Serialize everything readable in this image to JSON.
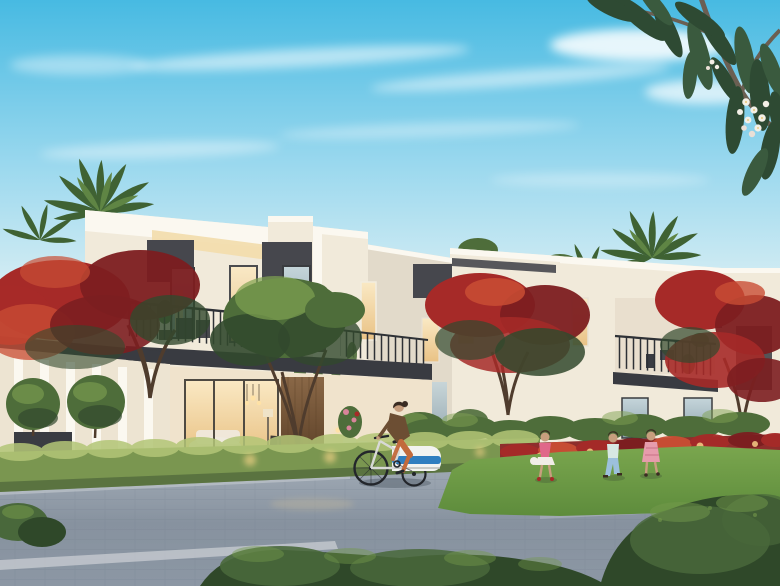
{
  "meta": {
    "kind": "architectural-rendering",
    "subject": "Modern two-storey townhouse community at dusk",
    "style": "photoreal real-estate marketing render",
    "text_visible": "none"
  },
  "scene": {
    "sky": {
      "condition": "clear with thin wispy clouds",
      "time": "early evening, warm horizon glow"
    },
    "architecture": {
      "type": "contemporary flat-roof townhouses",
      "storeys": 2,
      "facade": [
        "warm white render",
        "dark grey accent panels",
        "recessed lit soffits"
      ],
      "features": [
        "first-floor balconies with dark metal railings",
        "floor-to-ceiling glazing with warm interior light",
        "timber entrance panel",
        "pergola wing with white columns"
      ]
    },
    "vegetation": [
      "royal poinciana trees with red blossoms",
      "date palms",
      "frangipani branch with white flowers overhanging top-right",
      "clipped round trees",
      "green hedge with garden uplights",
      "red flowering hedge",
      "lawn",
      "low foreground shrubs"
    ],
    "people": [
      {
        "role": "resident",
        "location": "balcony of left townhouse",
        "clothing": "black top, grey trousers"
      },
      {
        "role": "cyclist",
        "location": "paved promenade",
        "clothing": "brown jacket, terracotta trousers",
        "accessory": "bicycle towing blue and white child trailer"
      },
      {
        "role": "child",
        "location": "lawn",
        "clothing": "pink top, white skirt, red shoes, carrying white ball"
      },
      {
        "role": "child",
        "location": "lawn",
        "clothing": "white-teal top, light blue trousers"
      },
      {
        "role": "child",
        "location": "lawn",
        "clothing": "pink patterned dress"
      }
    ],
    "ground": [
      "blue-grey paver plaza",
      "light stone kerb bands",
      "warm light pool reflections"
    ]
  },
  "palette": {
    "sky_top": "#47BAE2",
    "sky_mid": "#9AD8EE",
    "sky_low": "#D8EEF4",
    "sky_horizon": "#F3EEE1",
    "cloud": "#FFFFFF",
    "wall_bright": "#FBF8F0",
    "wall_light": "#F1EADA",
    "wall_shade": "#E2DACA",
    "wall_warm": "#F0E3CC",
    "soffit_glow": "#F2DDAE",
    "panel_dark": "#46474D",
    "fascia_dark": "#393B41",
    "railing": "#2E3136",
    "glass_cool": "#C5D5DA",
    "glass_cool_dark": "#8CA2AD",
    "glass_warm": "#E9C285",
    "window_glow": "#FAE9C4",
    "wood": "#8A6847",
    "wood_dark": "#5E4229",
    "foliage_dark": "#32492D",
    "foliage_mid": "#4E6D3A",
    "foliage_light": "#7FA251",
    "hedge_mid": "#7A9650",
    "hedge_light": "#B3C677",
    "palm_green": "#3F6233",
    "palm_light": "#5F8544",
    "palm_trunk": "#9A8668",
    "trunk_brown": "#4F3C2D",
    "flame_dark": "#7C1E20",
    "flame_red": "#A62A28",
    "flame_bright": "#C94E34",
    "lawn": "#7AA64E",
    "lawn_dark": "#5E8C3C",
    "pave_far": "#9DA7B2",
    "pave_mid": "#87929F",
    "pave_near": "#8C97A4",
    "curb": "#C9CED3",
    "pave_line": "#6E7A89",
    "bush_dark": "#2F4829",
    "bush_mid": "#49683B",
    "bush_light": "#74994B",
    "skin": "#C79E7E",
    "hair": "#3A2C22",
    "black_cloth": "#24262A",
    "grey_cloth": "#70717A",
    "trailer_blue": "#2F7EC0",
    "trailer_white": "#F2F3F1",
    "bike_frame": "#D8D9D6",
    "bike_dark": "#23262B",
    "jacket_brown": "#6C4E33",
    "pants_orange": "#C26A3C",
    "child_pink": "#E0688A",
    "child_skirt": "#F1EDE7",
    "child_teal": "#D7E8E3",
    "child_blue": "#9CC0DC",
    "child3_dress": "#E69CAC",
    "flower_pink": "#D9849A",
    "uplight": "#FFD98C",
    "light_warm": "#FFE2A6"
  }
}
